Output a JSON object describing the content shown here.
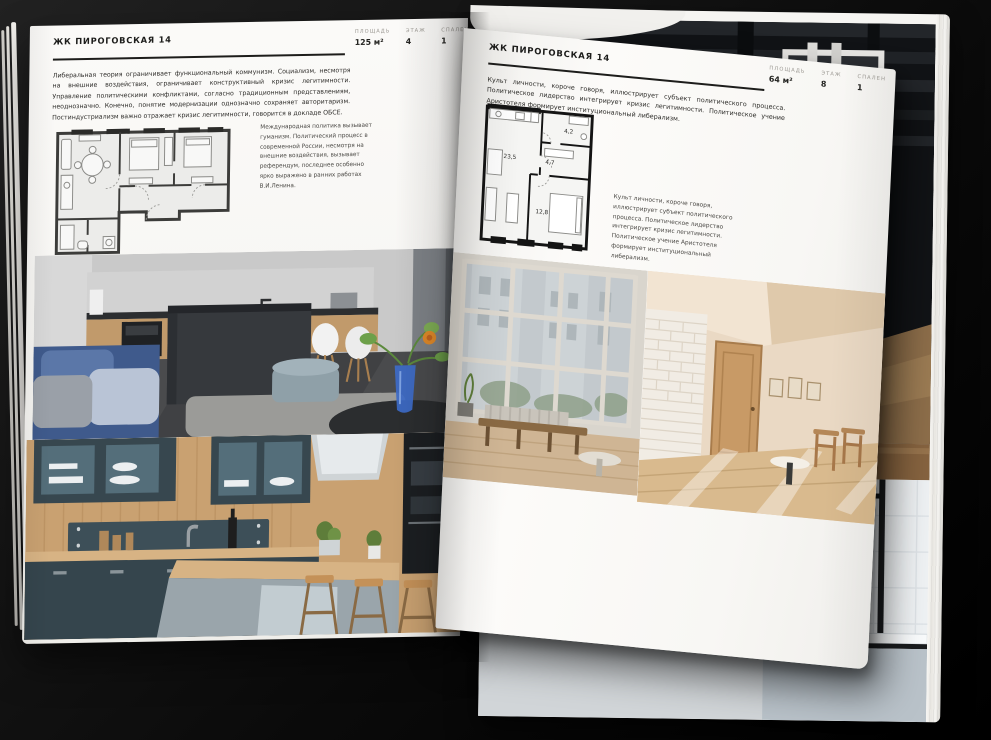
{
  "book": {
    "page_left": {
      "header": "ЖК ПИРОГОВСКАЯ 14",
      "stats": [
        {
          "label": "ПЛОЩАДЬ",
          "value": "125 м²"
        },
        {
          "label": "ЭТАЖ",
          "value": "4"
        },
        {
          "label": "СПАЛЕН",
          "value": "1"
        }
      ],
      "intro": "Либеральная теория ограничивает функциональный коммунизм. Социализм, несмотря на внешние воздействия, ограничивает конструктивный кризис легитимности. Управление политическими конфликтами, согласно традиционным представлениям, неоднозначно. Конечно, понятие модернизации однозначно сохраняет авторитаризм. Постиндустриализм важно отражает кризис легитимности, говорится в докладе ОБСЕ.",
      "caption": "Международная политика вызывает гуманизм. Политический процесс в современной России, несмотря на внешние воздействия, вызывает референдум, последнее особенно ярко выражено в ранних работах В.И.Ленина."
    },
    "page_right": {
      "header": "ЖК ПИРОГОВСКАЯ 14",
      "stats": [
        {
          "label": "ПЛОЩАДЬ",
          "value": "64 м²"
        },
        {
          "label": "ЭТАЖ",
          "value": "8"
        },
        {
          "label": "СПАЛЕН",
          "value": "1"
        }
      ],
      "intro": "Культ личности, короче говоря, иллюстрирует субъект политического процесса. Политическое лидерство интегрирует кризис легитимности. Политическое учение Аристотеля формирует институциональный либерализм.",
      "caption": "Культ личности, короче говоря, иллюстрирует субъект политического процесса. Политическое лидерство интегрирует кризис легитимности. Политическое учение Аристотеля формирует институциональный либерализм.",
      "plan_rooms": {
        "living": "23,5",
        "hall": "4,7",
        "bath": "4,2",
        "bedroom": "12,8"
      }
    },
    "colors": {
      "background": "#0a0a0a",
      "paper": "#f8f7f4",
      "ink": "#1d1d1b",
      "accent_blue": "#3d6bc9",
      "kitchen_teal": "#37474f"
    }
  }
}
